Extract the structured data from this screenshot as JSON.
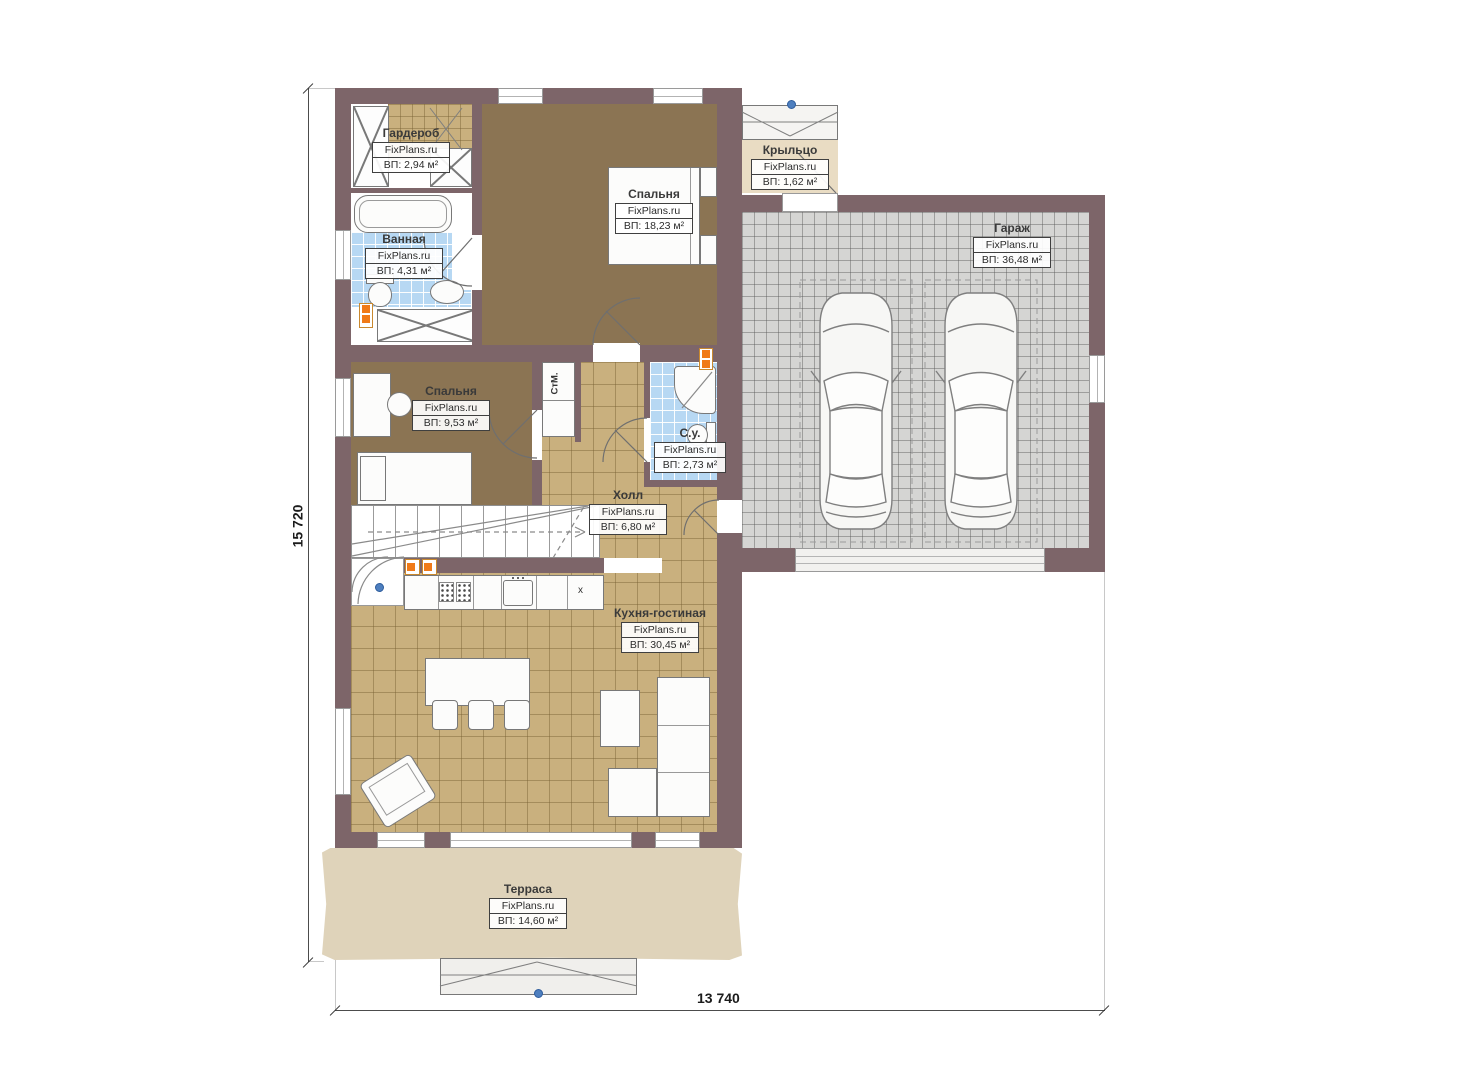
{
  "watermark": "FixPlans.ru",
  "rooms": [
    {
      "name": "Гардероб",
      "area": "ВП: 2,94 м²"
    },
    {
      "name": "Спальня",
      "area": "ВП: 18,23 м²"
    },
    {
      "name": "Ванная",
      "area": "ВП: 4,31 м²"
    },
    {
      "name": "Крыльцо",
      "area": "ВП: 1,62 м²"
    },
    {
      "name": "Гараж",
      "area": "ВП: 36,48 м²"
    },
    {
      "name": "Спальня",
      "area": "ВП: 9,53 м²"
    },
    {
      "name": "С.у.",
      "area": "ВП: 2,73 м²"
    },
    {
      "name": "Холл",
      "area": "ВП: 6,80 м²"
    },
    {
      "name": "Кухня-гостиная",
      "area": "ВП: 30,45 м²"
    },
    {
      "name": "Терраса",
      "area": "ВП: 14,60 м²"
    }
  ],
  "dimensions": {
    "height_mm": "15 720",
    "width_mm": "13 740"
  },
  "annotations": {
    "washing_machine": "СтМ.",
    "counter_marker": "x"
  },
  "palette": {
    "wall": "#7d6569",
    "bedroom_floor": "#8b7453",
    "tile_floor": "#c9b07e",
    "garage_floor": "#d5d5d3",
    "bath_floor": "#b7d8f3",
    "terrace": "#dfd3ba",
    "porch": "#e9dcc3",
    "radiator": "#f07a18",
    "marker": "#4e7fbf"
  }
}
